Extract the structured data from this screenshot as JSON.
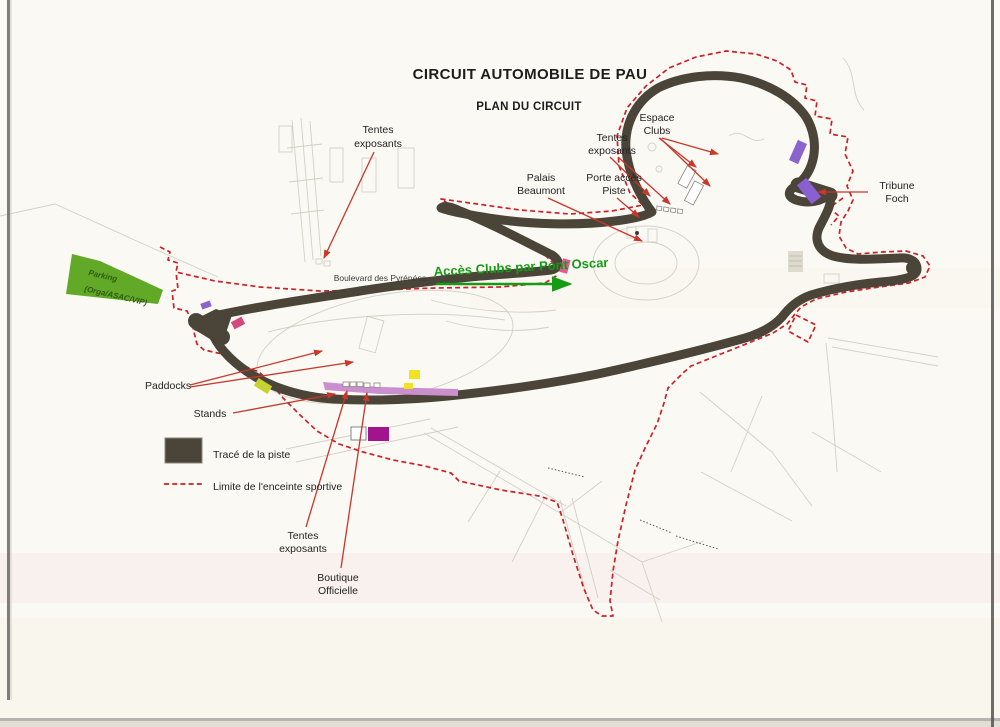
{
  "title": {
    "main": "CIRCUIT AUTOMOBILE DE PAU",
    "sub": "PLAN DU CIRCUIT"
  },
  "labels": {
    "tentes_nw_1": "Tentes",
    "tentes_nw_2": "exposants",
    "espace_clubs_1": "Espace",
    "espace_clubs_2": "Clubs",
    "tentes_n_1": "Tentes",
    "tentes_n_2": "exposants",
    "palais_1": "Palais",
    "palais_2": "Beaumont",
    "porte_1": "Porte accès",
    "porte_2": "Piste",
    "tribune_1": "Tribune",
    "tribune_2": "Foch",
    "paddocks": "Paddocks",
    "stands": "Stands",
    "tentes_s_1": "Tentes",
    "tentes_s_2": "exposants",
    "boutique_1": "Boutique",
    "boutique_2": "Officielle",
    "boulevard": "Boulevard des Pyrénées",
    "acces_clubs": "Accès Clubs par Pont Oscar",
    "parking_1": "Parking",
    "parking_2": "(Orga/ASAC/VIP)"
  },
  "legend": {
    "trace": "Tracé de la piste",
    "limite": "Limite de l'enceinte sportive"
  },
  "colors": {
    "paper": "#fbf9f4",
    "track": "#4a4538",
    "enclosure_line": "#cc2127",
    "annotation_arrow": "#c8372a",
    "acces_green": "#149c14",
    "parking_fill": "#63a928",
    "parking_text": "#2d5c0e",
    "stands_strip": "#cb8fd0",
    "boutique": "#a1148e",
    "tribune_purple": "#8a5fd0",
    "club_purple": "#8a63cc",
    "pink_marker": "#d4487e",
    "pont_oscar_pink": "#dd5f90",
    "yellow_marker": "#f2e320",
    "chartreuse_marker": "#c8d12f",
    "base_map_line": "#c9c5bc"
  }
}
